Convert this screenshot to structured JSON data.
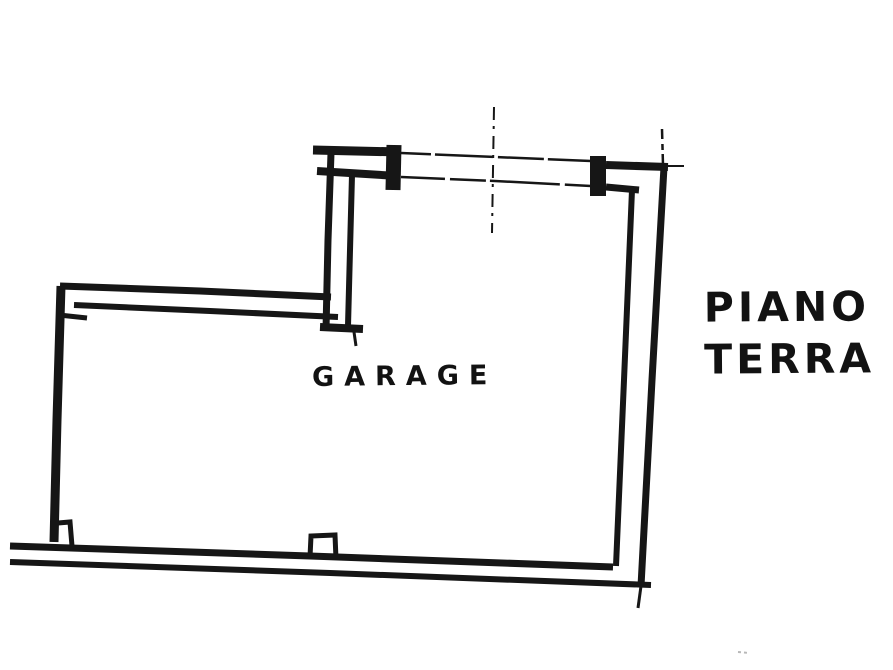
{
  "colors": {
    "background": "#ffffff",
    "ink": "#161616",
    "faint_mark": "#b8b8b8"
  },
  "floor_plan": {
    "room_label": "GARAGE",
    "floor_label_line1": "PIANO",
    "floor_label_line2": "TERRA"
  }
}
